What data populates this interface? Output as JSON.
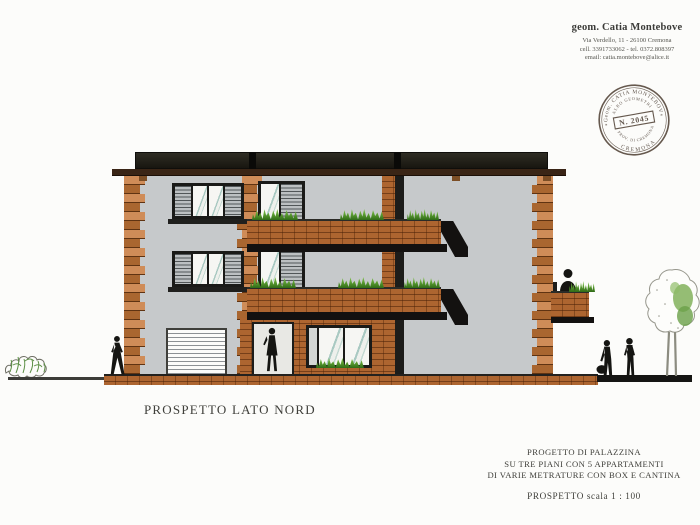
{
  "letterhead": {
    "name": "geom. Catia Montebove",
    "address": "Via Verdello, 11 - 26100 Cremona",
    "phone": "cell. 3391733062 - tel. 0372.808397",
    "email": "email: catia.montebove@alice.it"
  },
  "stamp": {
    "arc_top": "Geom. CATIA MONTEBOVE",
    "arc_inner_top": "ALBO GEOMETRI",
    "number": "N. 2045",
    "arc_inner_bottom": "PROV. DI CREMONA",
    "arc_bottom": "CREMONA",
    "ornament": "*",
    "ink_color": "#55493f"
  },
  "drawing": {
    "title": "PROSPETTO LATO NORD",
    "colors": {
      "facade": "#c6c9cb",
      "brick": "#ad6530",
      "roof": "#24221b",
      "fascia": "#3a2516",
      "slab": "#131110",
      "glass_reflection": "#a9c9c2",
      "shutter": "#bcc0c2",
      "plant_green": "#6fae3f",
      "silhouette": "#151512"
    }
  },
  "titleblock": {
    "line1": "PROGETTO DI PALAZZINA",
    "line2": "SU TRE PIANI CON 5 APPARTAMENTI",
    "line3": "DI VARIE METRATURE CON BOX E CANTINA",
    "scale": "PROSPETTO scala 1 : 100"
  }
}
